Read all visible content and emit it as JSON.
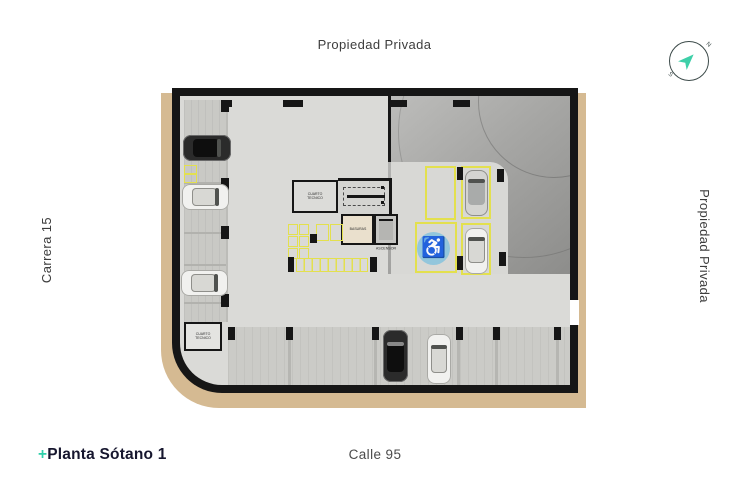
{
  "labels": {
    "top_street": "Propiedad Privada",
    "right_street": "Propiedad Privada",
    "left_street": "Carrera 15",
    "bottom_street": "Calle 95",
    "plan_title_prefix": "+",
    "plan_title": "Planta Sótano 1"
  },
  "compass": {
    "north": "N",
    "south": "S"
  },
  "plan": {
    "rooms": {
      "technical_room": "CUARTO TECNICO",
      "trash_room": "BASURAS",
      "elevator": "ASCENSOR"
    },
    "icons": {
      "accessible_parking": "♿"
    },
    "colors": {
      "accent_teal": "#3ecfa8",
      "sidewalk_tan": "#d5ba92",
      "parking_line_yellow": "#e3e04e",
      "accessible_blue": "#92c6dc"
    }
  }
}
